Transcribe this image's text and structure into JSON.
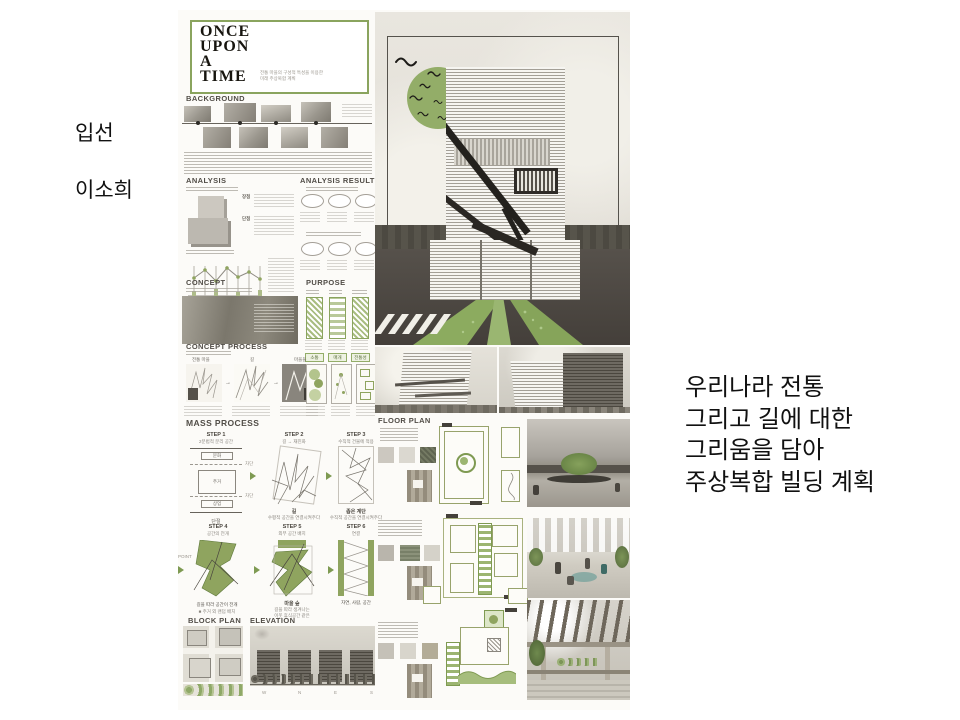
{
  "slide": {
    "award": "입선",
    "author": "이소희",
    "caption_lines": [
      "우리나라 전통",
      "그리고 길에 대한",
      "그리움을 담아",
      "주상복합 빌딩 계획"
    ]
  },
  "board": {
    "title_lines": [
      "ONCE",
      "UPON",
      "A",
      "TIME"
    ],
    "title_sub1": "전통 마을의 구성적 특성을 이용한",
    "title_sub2": "미래 주상복합 계획",
    "headings": {
      "background": "BACKGROUND",
      "analysis": "ANALYSIS",
      "analysis_result": "ANALYSIS RESULT",
      "concept": "CONCEPT",
      "purpose": "PURPOSE",
      "concept_process": "CONCEPT PROCESS",
      "mass_process": "MASS PROCESS",
      "block_plan": "BLOCK PLAN",
      "elevation": "ELEVATION",
      "floor_plan": "FLOOR PLAN"
    },
    "analysis": {
      "pros": "장점",
      "cons": "단점"
    },
    "concept_process": {
      "map1": "전통 마을",
      "map2": "길",
      "map3": "마을들",
      "tag1": "소통",
      "tag2": "매개",
      "tag3": "전통성"
    },
    "mass": {
      "s1": "STEP 1",
      "s1t": "2분법적 분리 공간",
      "s1a": "문화",
      "s1b": "주거",
      "s1c": "상업",
      "s1cut": "차단",
      "s1cap": "단절",
      "s2": "STEP 2",
      "s2t": "길 → 재진화",
      "s2cap": "길",
      "s2note": "수평적 공간을 연결시켜주다",
      "s3": "STEP 3",
      "s3t": "수직적 건물에 적용",
      "s3cap": "좁은 계단",
      "s3note": "수직적 공간을 연결시켜주다",
      "s4": "STEP 4",
      "s4t": "공간의 전개",
      "s4point": "POINT",
      "s4cap": "길을 따라 공간이 전개",
      "s4note": "■ 주거 외 랜덤 배치",
      "s5": "STEP 5",
      "s5t": "외부 공간 배치",
      "s5cap": "마을 숲",
      "s5note1": "길을 따라 생겨나는",
      "s5note2": "이웃 휴식공간 같은",
      "s6": "STEP 6",
      "s6t": "연결",
      "s6cap": "자연, 사람, 공간"
    },
    "elevation_letters": {
      "w": "W",
      "n": "N",
      "e": "E",
      "s": "S"
    }
  },
  "colors": {
    "accent_green": "#8fa45f",
    "ground": "#4a443e",
    "board_bg": "#fcfbf8"
  }
}
